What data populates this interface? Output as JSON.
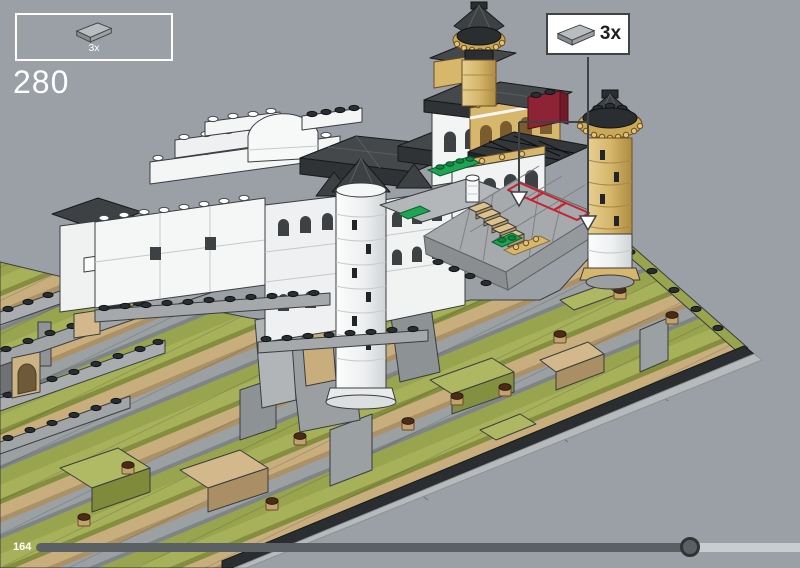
{
  "viewer": {
    "background_color": "#9aa0a5",
    "content": "isometric 3D LEGO building-instruction render of a hillside castle model on a black-edged baseplate"
  },
  "step_panel": {
    "step_number": "280",
    "parts": [
      {
        "name": "light-gray-2x4-tile",
        "quantity_label": "3x"
      }
    ]
  },
  "callout": {
    "part_name": "light-gray-2x4-tile",
    "quantity_label": "3x",
    "placements": 3,
    "highlight_color": "#c8202e"
  },
  "progress": {
    "position_label": "164",
    "fraction": 0.856
  },
  "scene": {
    "palette": {
      "background": "#9aa0a5",
      "white_walls": "#f4f5f6",
      "roof_dark": "#3e4144",
      "terrain_olive": "#a7b15a",
      "terrain_tan": "#c9ae7d",
      "terrain_gray": "#9ba0a3",
      "tower_gold": "#d6b76b",
      "accent_red": "#8e2336",
      "tile_green": "#1ea452",
      "baseplate_black": "#2b2e31"
    }
  }
}
